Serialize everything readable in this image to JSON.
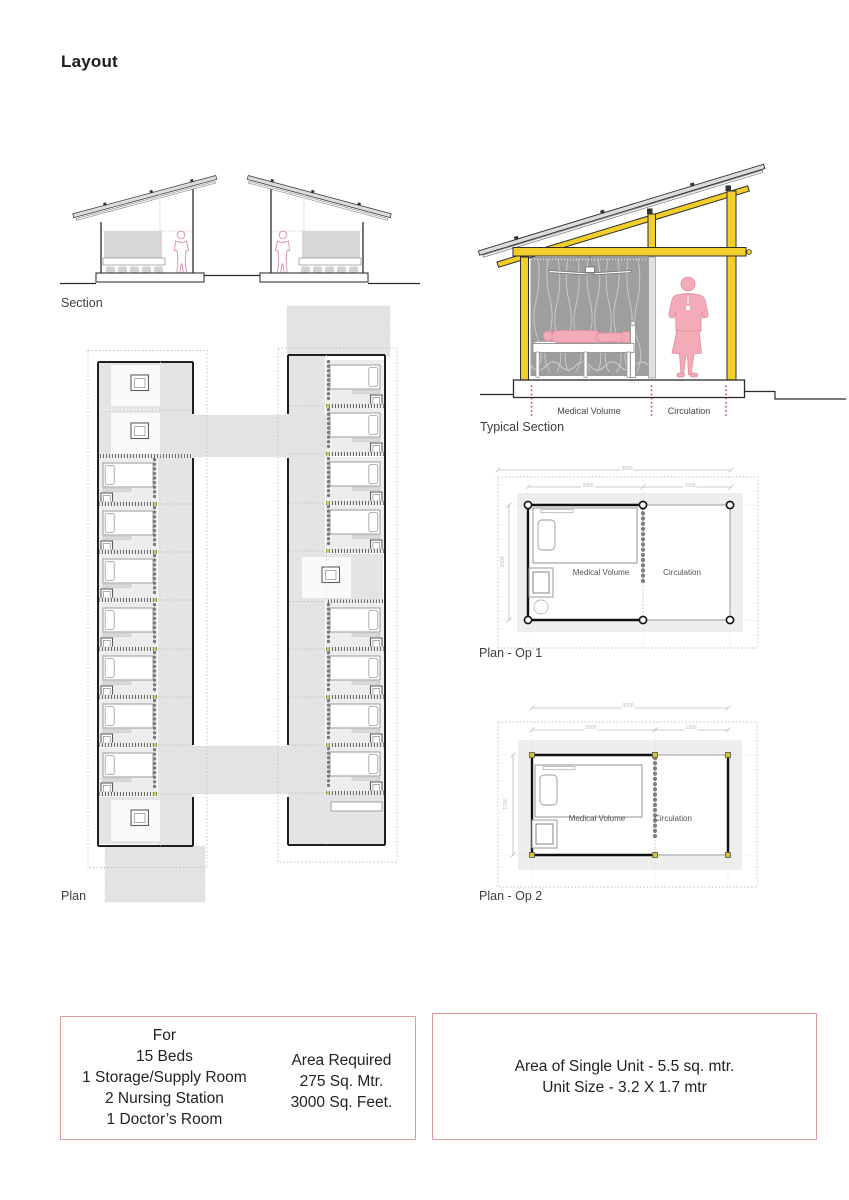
{
  "title": "Layout",
  "labels": {
    "section": "Section",
    "typical_section": "Typical Section",
    "plan": "Plan",
    "plan_op1": "Plan - Op 1",
    "plan_op2": "Plan - Op 2"
  },
  "typical_section": {
    "medical_zone": "Medical Volume",
    "circulation_zone": "Circulation"
  },
  "plan_op1": {
    "dim_total": "3500",
    "dim_medical": "2000",
    "dim_circulation": "1500",
    "dim_depth": "2000",
    "medical_zone": "Medical Volume",
    "circulation_zone": "Circulation"
  },
  "plan_op2": {
    "dim_total": "3200",
    "dim_medical": "2000",
    "dim_circulation": "1200",
    "dim_depth": "1700",
    "medical_zone": "Medical Volume",
    "circulation_zone": "Circulation"
  },
  "requirements_box": {
    "lines_left": [
      "For",
      "15 Beds",
      "1 Storage/Supply Room",
      "2 Nursing Station",
      "1 Doctor’s Room"
    ],
    "lines_right": [
      "Area Required",
      "275 Sq. Mtr.",
      "3000 Sq. Feet."
    ]
  },
  "unit_box": {
    "lines": [
      "Area of Single Unit - 5.5 sq. mtr.",
      "Unit Size - 3.2 X 1.7 mtr"
    ]
  },
  "colors": {
    "structure_yellow": "#F2CE2B",
    "figure_pink": "#F3ABB8",
    "box_border_pink": "#DE9B9B",
    "marker_red": "#E03131",
    "curtain_gray": "#9E9E9E"
  }
}
